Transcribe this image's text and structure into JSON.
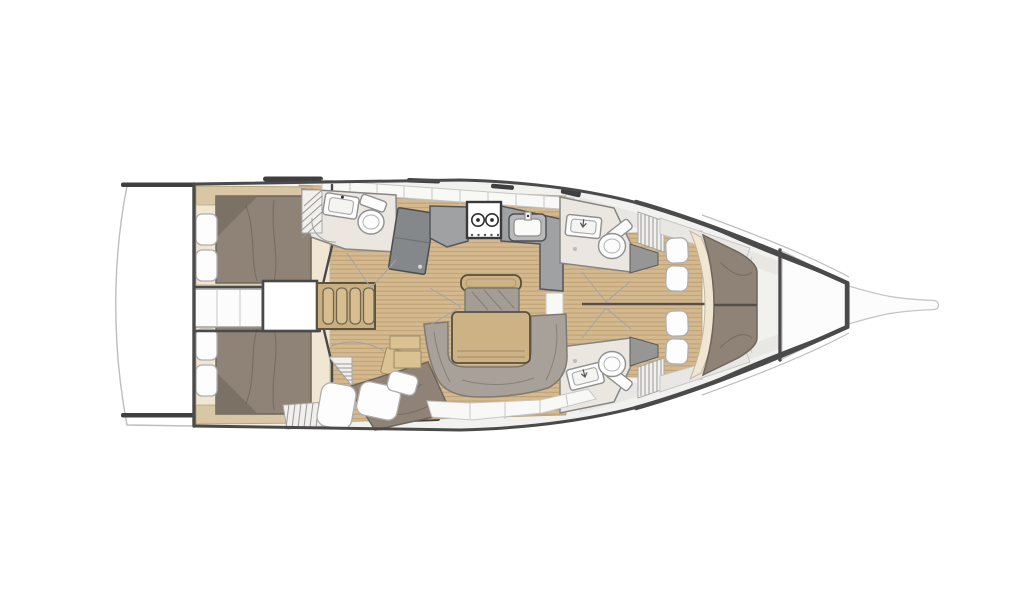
{
  "figure": {
    "kind": "sailing-yacht-interior-floor-plan",
    "view": "top-down",
    "orientation": "bow-right",
    "cabins_count": 4,
    "heads_count": 3
  },
  "palette": {
    "hull_fill": "#ffffff",
    "hull_line": "#4a4a4a",
    "thin_line": "#bdbdbd",
    "interior": "#f1f1ef",
    "panel": "#e8e7e4",
    "panel_seam": "#c6c6c6",
    "wood": "#d4b88e",
    "wood_line": "#bb9d72",
    "cream": "#f0e6d1",
    "tan": "#cdb286",
    "tan_dark": "#56503f",
    "mattress": "#8e8376",
    "mattress_dark": "#6e665b",
    "sofa": "#a7a199",
    "sofa_line": "#7f7970",
    "counter": "#9fa1a3",
    "counter_dark": "#54565a",
    "navtable": "#85888b",
    "head_floor": "#ebe7e0",
    "fixture": "#fcfcfc",
    "fixture_line": "#8f8f8f",
    "pillow": "#fdfdfd",
    "pillow_line": "#aeaeae",
    "hardware": "#3f3f3f",
    "arc": "#a3a3a3"
  },
  "semantics": {
    "vessel": "Sailing yacht interior layout, top view, bow to the right",
    "rooms": {
      "swim_platform": "Swim platform and transom",
      "aft_cabin_starboard": "Aft double cabin starboard",
      "aft_cabin_port": "Aft double cabin port",
      "engine_room": "Engine compartment",
      "companionway": "Companionway hatch",
      "ladder": "Companionway steps",
      "aft_head": "Aft head with WC and shower",
      "nav_station": "Chart table",
      "galley": "Galley with stove and sink",
      "saloon": "Saloon with U-shaped sofa and table",
      "mid_cabin": "Mid double berth port side",
      "fwd_head_starboard": "Forward head starboard",
      "fwd_head_port": "Forward head port",
      "fwd_cabin": "Forward owner cabin with V-berth",
      "forepeak": "Forepeak anchor locker",
      "bowsprit": "Bowsprit"
    }
  }
}
